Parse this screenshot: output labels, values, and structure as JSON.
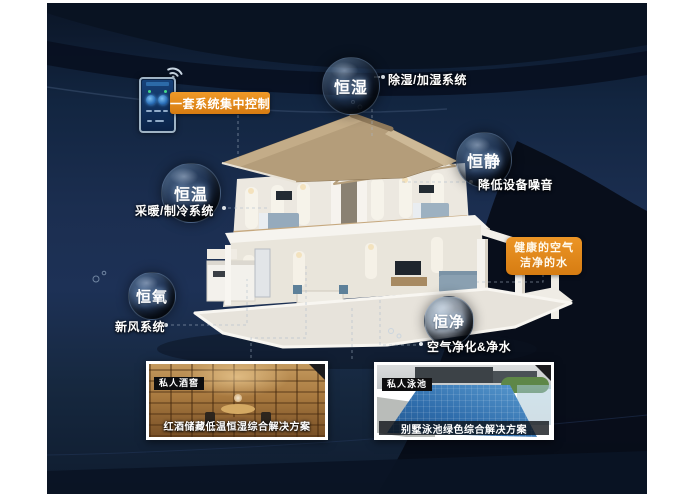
{
  "poster": {
    "type": "smart-home constant-system infographic",
    "control_tag": "一套系统集中控制",
    "highlight_box": {
      "line1": "健康的空气",
      "line2": "洁净的水"
    }
  },
  "bubbles": [
    {
      "label": "恒湿",
      "desc": "除湿/加湿系统"
    },
    {
      "label": "恒静",
      "desc": "降低设备噪音"
    },
    {
      "label": "恒温",
      "desc": "采暖/制冷系统"
    },
    {
      "label": "恒氧",
      "desc": "新风系统"
    },
    {
      "label": "恒净",
      "desc": "空气净化&净水"
    }
  ],
  "cards": [
    {
      "tag": "私人酒窖",
      "caption": "红酒储藏低温恒湿综合解决方案"
    },
    {
      "tag": "私人泳池",
      "caption": "别墅泳池绿色综合解决方案"
    }
  ],
  "icons": [
    "wifi-icon",
    "smartphone-icon",
    "corner-ribbon"
  ],
  "colors": {
    "accent_orange": "#e0861c",
    "canvas_navy": "#16283f",
    "bubble_rim": "#91afd2",
    "pool_blue": "#2e6cab",
    "wine_wood": "#a8793f"
  }
}
